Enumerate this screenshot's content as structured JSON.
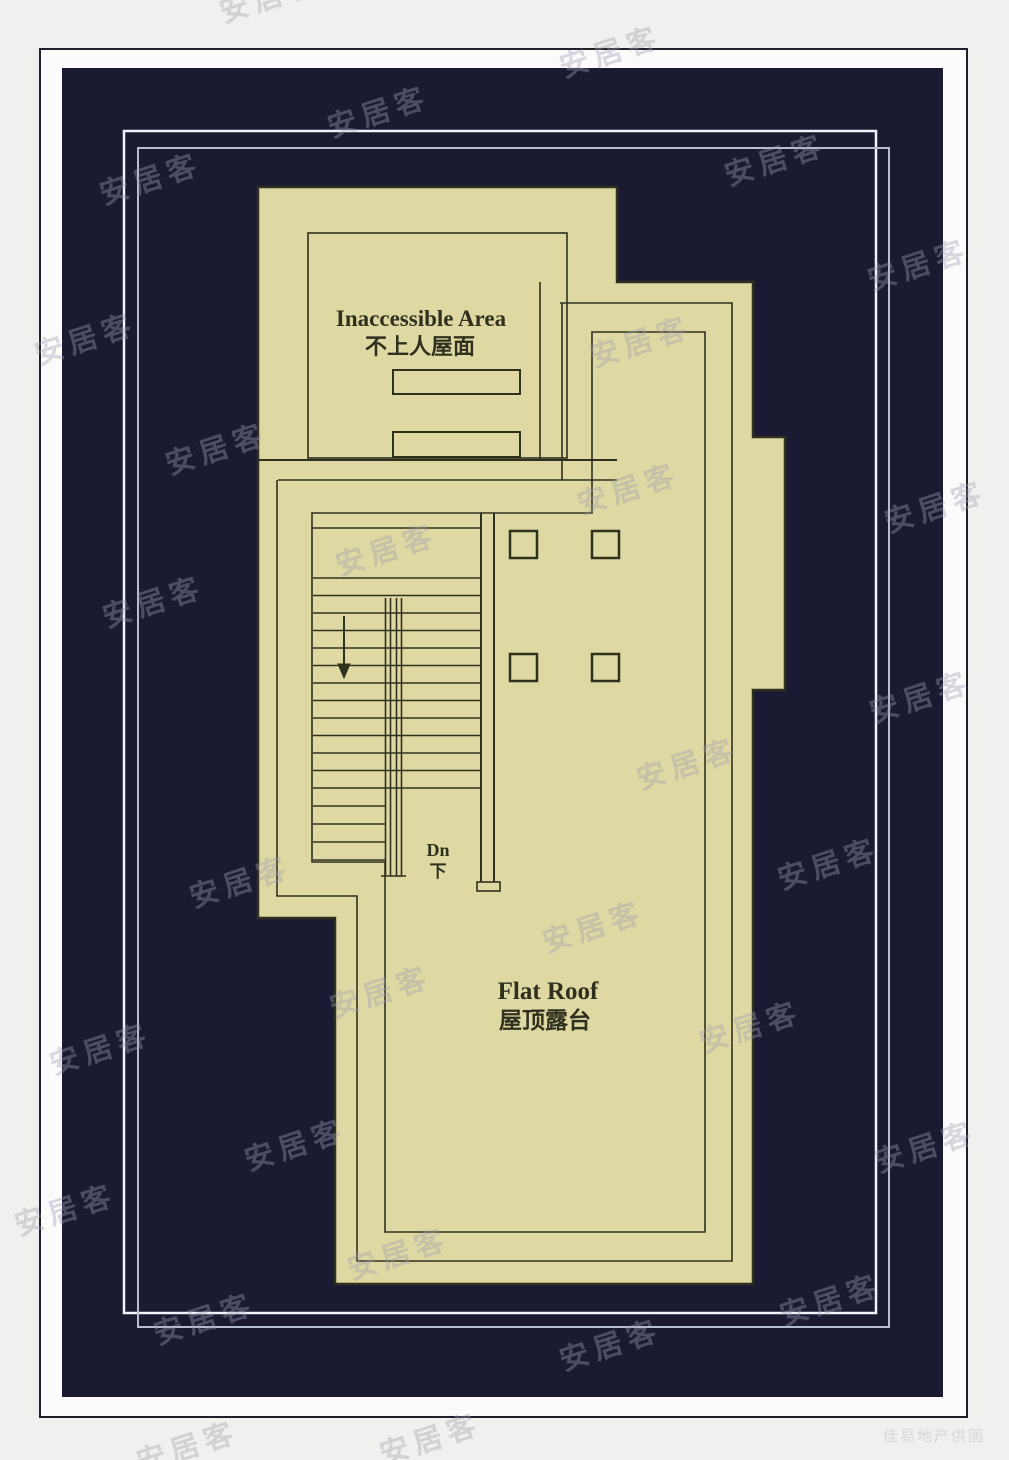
{
  "plan": {
    "labels": {
      "inaccessible_en": "Inaccessible Area",
      "inaccessible_zh": "不上人屋面",
      "flat_roof_en": "Flat Roof",
      "flat_roof_zh": "屋顶露台",
      "down_en": "Dn",
      "down_zh": "下"
    },
    "colors": {
      "background_page": "#f0f0ee",
      "border_line": "#20202a",
      "inner_margin": "#fbfbfc",
      "navy": "#1a1a33",
      "frame_bright": "#f2f3fb",
      "frame_dim": "#b8bdd3",
      "roof_fill": "#ded8a2",
      "roof_line": "#30301f",
      "caption": "#d7d7d7",
      "watermark": "rgba(158,158,175,0.38)"
    }
  },
  "caption": {
    "text": "佳易地产供图"
  },
  "watermark": {
    "text": "安居客",
    "positions": [
      [
        270,
        -5
      ],
      [
        610,
        50
      ],
      [
        378,
        110
      ],
      [
        150,
        177
      ],
      [
        775,
        158
      ],
      [
        918,
        263
      ],
      [
        85,
        337
      ],
      [
        640,
        340
      ],
      [
        216,
        447
      ],
      [
        628,
        487
      ],
      [
        935,
        505
      ],
      [
        386,
        548
      ],
      [
        153,
        600
      ],
      [
        920,
        695
      ],
      [
        687,
        762
      ],
      [
        828,
        862
      ],
      [
        240,
        880
      ],
      [
        593,
        925
      ],
      [
        380,
        990
      ],
      [
        100,
        1047
      ],
      [
        750,
        1025
      ],
      [
        295,
        1143
      ],
      [
        925,
        1145
      ],
      [
        65,
        1208
      ],
      [
        398,
        1252
      ],
      [
        204,
        1317
      ],
      [
        830,
        1298
      ],
      [
        610,
        1343
      ],
      [
        187,
        1445
      ],
      [
        430,
        1437
      ]
    ]
  }
}
